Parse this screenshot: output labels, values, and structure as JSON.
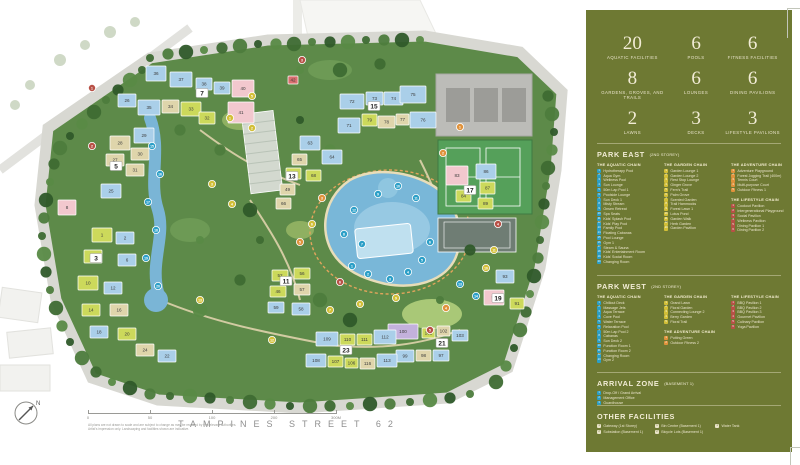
{
  "sidebar": {
    "bg": "#6e7933",
    "text_color": "#efe9d2",
    "stats": [
      {
        "value": "20",
        "label": "AQUATIC FACILITIES"
      },
      {
        "value": "6",
        "label": "POOLS"
      },
      {
        "value": "6",
        "label": "FITNESS FACILITIES"
      },
      {
        "value": "8",
        "label": "GARDENS, GROVES, AND TRAILS"
      },
      {
        "value": "6",
        "label": "LOUNGES"
      },
      {
        "value": "6",
        "label": "DINING PAVILIONS"
      },
      {
        "value": "2",
        "label": "LAWNS"
      },
      {
        "value": "3",
        "label": "DECKS"
      },
      {
        "value": "3",
        "label": "LIFESTYLE PAVILIONS"
      }
    ],
    "chain_colors": {
      "aquatic": "#2b9fc7",
      "garden": "#d2bf37",
      "adventure": "#e0923b",
      "lifestyle": "#b85046",
      "arrival": "#2b9fc7",
      "other": "#e9e3c8"
    },
    "park_east": {
      "title": "PARK EAST",
      "storey": "(2ND STOREY)",
      "columns": [
        [
          {
            "name": "THE AQUATIC CHAIN",
            "color_key": "aquatic",
            "items": [
              "Hydrotherapy Pool",
              "Aqua Gym",
              "Wellness Pool",
              "Sun Lounge",
              "50m Lap Pool 1",
              "Poolside Lounge",
              "Sun Deck 1",
              "Misty Stream",
              "Onsen Retreat",
              "Spa Seats",
              "Kids' Splash Pool",
              "Kids' Play Pool",
              "Family Pool",
              "Floating Cabanas",
              "Pool Lounge",
              "Gym 1",
              "Steam & Sauna",
              "Kids' Entertainment Room",
              "Kids' Social Room",
              "Changing Room"
            ]
          }
        ],
        [
          {
            "name": "THE GARDEN CHAIN",
            "color_key": "garden",
            "items": [
              "Garden Lounge 1",
              "Garden Lounge 2",
              "Rest Stop Lounge",
              "Ginger Grove",
              "Fern's Trail",
              "Palm Grove",
              "Scented Garden",
              "Trail Hammocks",
              "Forest Lawn 1",
              "Lotus Pond",
              "Garden Walk",
              "Herb Garden",
              "Garden Pavilion"
            ]
          }
        ],
        [
          {
            "name": "THE ADVENTURE CHAIN",
            "color_key": "adventure",
            "items": [
              "Adventure Playground",
              "Forest Jogging Trail (400m)",
              "Tennis Court",
              "Multi-purpose Court",
              "Outdoor Fitness 1"
            ]
          },
          {
            "name": "THE LIFESTYLE CHAIN",
            "color_key": "lifestyle",
            "items": [
              "Cookout Pavilion",
              "Intergenerational Playground",
              "Social Pavilion",
              "Wellness Pavilion",
              "Dining Pavilion 1",
              "Dining Pavilion 2"
            ]
          }
        ]
      ]
    },
    "park_west": {
      "title": "PARK WEST",
      "storey": "(2ND STOREY)",
      "columns": [
        [
          {
            "name": "THE AQUATIC CHAIN",
            "color_key": "aquatic",
            "items": [
              "Chillout Deck",
              "Massage Jets",
              "Aqua Terrace",
              "Cove Pool",
              "Water Terrace",
              "Relaxation Pool",
              "50m Lap Pool 2",
              "Cabanas",
              "Sun Deck 2",
              "Function Room 1",
              "Function Room 2",
              "Changing Room",
              "Gym 2"
            ]
          }
        ],
        [
          {
            "name": "THE GARDEN CHAIN",
            "color_key": "garden",
            "items": [
              "Grand Lawn",
              "Floral Garden",
              "Connecting Lounge 2",
              "Berry Garden",
              "Floral Trail"
            ]
          },
          {
            "name": "THE ADVENTURE CHAIN",
            "color_key": "adventure",
            "items": [
              "Putting Green",
              "Outdoor Fitness 2"
            ]
          }
        ],
        [
          {
            "name": "THE LIFESTYLE CHAIN",
            "color_key": "lifestyle",
            "items": [
              "BBQ Pavilion 1",
              "BBQ Pavilion 2",
              "BBQ Pavilion 3",
              "Gourmet Pavilion",
              "Culinary Pavilion",
              "Yoga Pavilion"
            ]
          }
        ]
      ]
    },
    "arrival": {
      "title": "ARRIVAL ZONE",
      "storey": "(BASEMENT 1)",
      "items": [
        "Drop-Off / Grand Arrival",
        "Management Office",
        "Guardhouse"
      ]
    },
    "other": {
      "title": "OTHER FACILITIES",
      "columns": [
        [
          "Gateway (1st Storey)",
          "Substation (Basement 1)"
        ],
        [
          "Bin Centre (Basement 1)",
          "Bicycle Lots (Basement 1)"
        ],
        [
          "Water Tank"
        ]
      ]
    }
  },
  "map": {
    "street_label": "TAMPINES STREET 62",
    "compass_label": "N",
    "scale_ticks": [
      "0",
      "50",
      "100",
      "200",
      "300M"
    ],
    "disclaimers": [
      "All plans are not drawn to scale and are subject to change as may be required by the relevant authorities.",
      "Artist's impression only. Landscaping and facilities shown are indicative."
    ],
    "palette": {
      "blue": "#aacfe9",
      "yellow": "#ccd95b",
      "beige": "#dfd5ab",
      "pink": "#f2c8ce",
      "purple": "#c3b1dc",
      "red": "#d96f6f"
    },
    "marker_colors": {
      "aq": "#2b9fc7",
      "gd": "#d2bf37",
      "ad": "#e0923b",
      "ls": "#b85046"
    },
    "block_labels": [
      [
        "3",
        96,
        258
      ],
      [
        "5",
        116,
        166
      ],
      [
        "7",
        202,
        93
      ],
      [
        "11",
        286,
        281
      ],
      [
        "13",
        292,
        176
      ],
      [
        "15",
        374,
        106
      ],
      [
        "17",
        470,
        190
      ],
      [
        "19",
        498,
        298
      ],
      [
        "21",
        442,
        343
      ],
      [
        "23",
        346,
        350
      ]
    ],
    "buildings": [
      [
        "26",
        "blue",
        118,
        94,
        18,
        13
      ],
      [
        "36",
        "blue",
        146,
        66,
        20,
        15
      ],
      [
        "37",
        "blue",
        170,
        72,
        22,
        15
      ],
      [
        "38",
        "blue",
        196,
        78,
        16,
        12
      ],
      [
        "39",
        "blue",
        214,
        82,
        16,
        12
      ],
      [
        "40",
        "pink",
        232,
        80,
        22,
        17
      ],
      [
        "41",
        "pink",
        228,
        102,
        26,
        21
      ],
      [
        "35",
        "blue",
        138,
        100,
        22,
        15
      ],
      [
        "34",
        "beige",
        162,
        100,
        17,
        13
      ],
      [
        "33",
        "yellow",
        181,
        102,
        20,
        14
      ],
      [
        "32",
        "yellow",
        199,
        112,
        16,
        12
      ],
      [
        "42",
        "red",
        288,
        76,
        10,
        8
      ],
      [
        "28",
        "beige",
        110,
        136,
        20,
        14
      ],
      [
        "29",
        "blue",
        134,
        128,
        20,
        15
      ],
      [
        "30",
        "beige",
        131,
        148,
        18,
        12
      ],
      [
        "27",
        "beige",
        106,
        154,
        18,
        12
      ],
      [
        "31",
        "beige",
        126,
        164,
        18,
        12
      ],
      [
        "25",
        "blue",
        101,
        184,
        20,
        14
      ],
      [
        "8",
        "pink",
        58,
        200,
        18,
        15
      ],
      [
        "1",
        "yellow",
        92,
        228,
        20,
        14
      ],
      [
        "2",
        "blue",
        116,
        232,
        18,
        12
      ],
      [
        "4",
        "yellow",
        84,
        250,
        18,
        13
      ],
      [
        "6",
        "blue",
        118,
        254,
        18,
        12
      ],
      [
        "10",
        "yellow",
        78,
        276,
        20,
        14
      ],
      [
        "12",
        "blue",
        104,
        282,
        18,
        12
      ],
      [
        "14",
        "yellow",
        82,
        304,
        18,
        12
      ],
      [
        "16",
        "beige",
        110,
        304,
        18,
        12
      ],
      [
        "18",
        "blue",
        90,
        326,
        18,
        12
      ],
      [
        "20",
        "yellow",
        118,
        328,
        18,
        12
      ],
      [
        "24",
        "beige",
        136,
        344,
        18,
        12
      ],
      [
        "22",
        "blue",
        158,
        350,
        18,
        12
      ],
      [
        "52",
        "yellow",
        272,
        270,
        16,
        11
      ],
      [
        "56",
        "yellow",
        294,
        268,
        16,
        11
      ],
      [
        "57",
        "beige",
        294,
        284,
        16,
        11
      ],
      [
        "46",
        "yellow",
        270,
        286,
        16,
        11
      ],
      [
        "59",
        "blue",
        268,
        302,
        16,
        11
      ],
      [
        "58",
        "blue",
        292,
        303,
        18,
        12
      ],
      [
        "63",
        "blue",
        300,
        136,
        20,
        14
      ],
      [
        "64",
        "blue",
        322,
        150,
        20,
        14
      ],
      [
        "65",
        "beige",
        292,
        154,
        15,
        11
      ],
      [
        "61",
        "yellow",
        286,
        168,
        15,
        11
      ],
      [
        "49",
        "beige",
        280,
        184,
        15,
        11
      ],
      [
        "68",
        "yellow",
        306,
        170,
        15,
        11
      ],
      [
        "66",
        "beige",
        276,
        198,
        15,
        11
      ],
      [
        "72",
        "blue",
        340,
        94,
        24,
        15
      ],
      [
        "73",
        "blue",
        366,
        92,
        17,
        13
      ],
      [
        "74",
        "blue",
        384,
        92,
        19,
        13
      ],
      [
        "75",
        "blue",
        400,
        86,
        26,
        17
      ],
      [
        "71",
        "blue",
        338,
        118,
        22,
        15
      ],
      [
        "79",
        "yellow",
        362,
        114,
        15,
        12
      ],
      [
        "78",
        "beige",
        378,
        116,
        17,
        12
      ],
      [
        "77",
        "beige",
        396,
        114,
        13,
        11
      ],
      [
        "76",
        "blue",
        410,
        112,
        26,
        16
      ],
      [
        "83",
        "pink",
        446,
        166,
        22,
        19
      ],
      [
        "86",
        "blue",
        476,
        164,
        20,
        15
      ],
      [
        "87",
        "yellow",
        480,
        182,
        15,
        12
      ],
      [
        "84",
        "yellow",
        456,
        190,
        15,
        12
      ],
      [
        "89",
        "yellow",
        478,
        198,
        15,
        11
      ],
      [
        "93",
        "blue",
        496,
        270,
        18,
        13
      ],
      [
        "95",
        "pink",
        484,
        290,
        20,
        15
      ],
      [
        "91",
        "yellow",
        510,
        298,
        14,
        11
      ],
      [
        "100",
        "purple",
        388,
        324,
        30,
        15
      ],
      [
        "101",
        "yellow",
        422,
        328,
        13,
        10
      ],
      [
        "102",
        "beige",
        437,
        326,
        13,
        10
      ],
      [
        "103",
        "blue",
        452,
        330,
        16,
        11
      ],
      [
        "99",
        "blue",
        396,
        350,
        18,
        12
      ],
      [
        "98",
        "beige",
        416,
        350,
        15,
        11
      ],
      [
        "97",
        "blue",
        433,
        350,
        16,
        11
      ],
      [
        "109",
        "blue",
        316,
        332,
        22,
        14
      ],
      [
        "110",
        "yellow",
        340,
        334,
        15,
        11
      ],
      [
        "111",
        "yellow",
        357,
        334,
        15,
        11
      ],
      [
        "112",
        "blue",
        374,
        330,
        22,
        14
      ],
      [
        "108",
        "blue",
        306,
        354,
        20,
        13
      ],
      [
        "107",
        "yellow",
        328,
        356,
        15,
        11
      ],
      [
        "106",
        "yellow",
        345,
        358,
        13,
        10
      ],
      [
        "116",
        "beige",
        360,
        358,
        15,
        11
      ],
      [
        "113",
        "blue",
        377,
        354,
        20,
        13
      ]
    ],
    "markers": [
      [
        "1",
        "aq",
        352,
        266
      ],
      [
        "2",
        "aq",
        368,
        274
      ],
      [
        "3",
        "aq",
        390,
        279
      ],
      [
        "4",
        "aq",
        408,
        272
      ],
      [
        "5",
        "aq",
        422,
        260
      ],
      [
        "6",
        "aq",
        430,
        242
      ],
      [
        "7",
        "aq",
        362,
        244
      ],
      [
        "8",
        "aq",
        344,
        234
      ],
      [
        "9",
        "aq",
        378,
        194
      ],
      [
        "10",
        "aq",
        398,
        186
      ],
      [
        "11",
        "aq",
        416,
        198
      ],
      [
        "12",
        "aq",
        354,
        210
      ],
      [
        "13",
        "aq",
        460,
        284
      ],
      [
        "14",
        "aq",
        476,
        296
      ],
      [
        "15",
        "aq",
        152,
        146
      ],
      [
        "16",
        "aq",
        160,
        174
      ],
      [
        "17",
        "aq",
        148,
        202
      ],
      [
        "18",
        "aq",
        156,
        230
      ],
      [
        "19",
        "aq",
        146,
        258
      ],
      [
        "20",
        "aq",
        158,
        286
      ],
      [
        "1",
        "gd",
        230,
        118
      ],
      [
        "2",
        "gd",
        252,
        128
      ],
      [
        "3",
        "gd",
        212,
        184
      ],
      [
        "4",
        "gd",
        232,
        204
      ],
      [
        "5",
        "gd",
        252,
        96
      ],
      [
        "6",
        "gd",
        312,
        224
      ],
      [
        "7",
        "gd",
        330,
        310
      ],
      [
        "8",
        "gd",
        360,
        304
      ],
      [
        "9",
        "gd",
        396,
        298
      ],
      [
        "10",
        "gd",
        486,
        268
      ],
      [
        "11",
        "gd",
        494,
        250
      ],
      [
        "12",
        "gd",
        272,
        340
      ],
      [
        "13",
        "gd",
        200,
        300
      ],
      [
        "1",
        "ad",
        460,
        127
      ],
      [
        "2",
        "ad",
        443,
        153
      ],
      [
        "3",
        "ad",
        322,
        198
      ],
      [
        "4",
        "ad",
        446,
        308
      ],
      [
        "5",
        "ad",
        300,
        242
      ],
      [
        "1",
        "ls",
        92,
        88
      ],
      [
        "2",
        "ls",
        92,
        146
      ],
      [
        "3",
        "ls",
        302,
        60
      ],
      [
        "4",
        "ls",
        498,
        224
      ],
      [
        "5",
        "ls",
        430,
        330
      ],
      [
        "6",
        "ls",
        340,
        282
      ]
    ]
  }
}
